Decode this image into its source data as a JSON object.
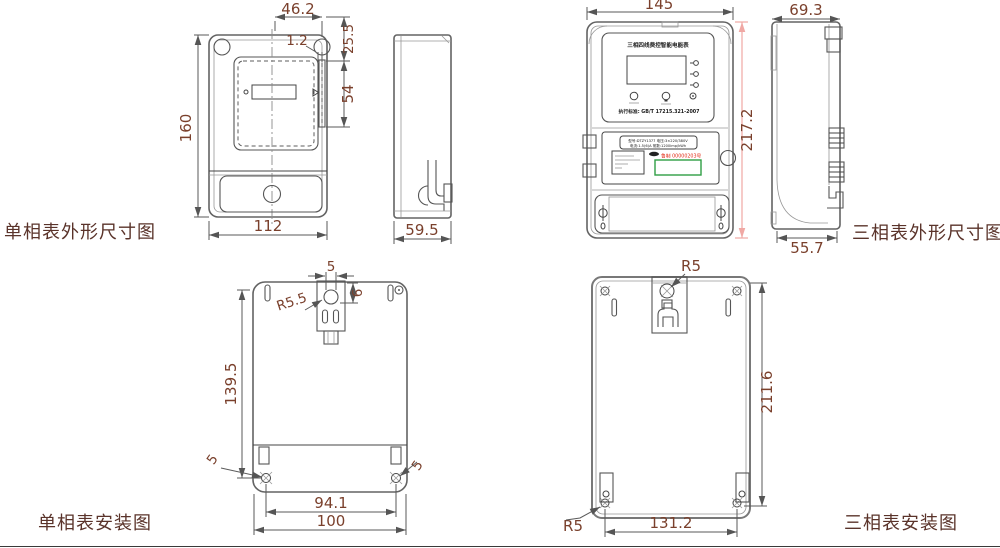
{
  "colors": {
    "background": "#ffffff",
    "drawing_line": "#5f5f5f",
    "dimension_text": "#7a402c",
    "label_text": "#5a332a",
    "pink_dimension_line": "#f0a8a4",
    "serial_red": "#e02812",
    "barcode_green": "#2f9e44"
  },
  "drawings": {
    "single_outline": {
      "label": "单相表外形尺寸图",
      "front_dims": {
        "top_width": "46.2",
        "gap": "1.2",
        "upper_height": "25.5",
        "window_height": "54",
        "height": "160",
        "width": "112"
      },
      "side_dims": {
        "depth": "59.5"
      }
    },
    "three_outline": {
      "label": "三相表外形尺寸图",
      "front_dims": {
        "width": "145",
        "height": "217.2"
      },
      "side_dims": {
        "top_depth": "69.3",
        "bottom_depth": "55.7"
      },
      "face": {
        "title": "三相四线费控智能电能表",
        "standard": "执行标准: GB/T 17215.321-2007"
      },
      "nameplate": {
        "spec_line1": "型号:DTZY1377 电压:3×220/380V",
        "spec_line2": "电流:1.5(6)A 常数:1200imp/kWh",
        "serial": "鲁制 00000203号"
      }
    },
    "single_install": {
      "label": "单相表安装图",
      "dims": {
        "slot_width": "5",
        "slot_offset": "6",
        "hook_radius": "R5.5",
        "height": "139.5",
        "hole_left": "5",
        "hole_right": "5",
        "inner_span": "94.1",
        "outer_span": "100"
      }
    },
    "three_install": {
      "label": "三相表安装图",
      "dims": {
        "hook_radius": "R5",
        "height": "211.6",
        "corner_radius": "R5",
        "width": "131.2"
      }
    }
  }
}
